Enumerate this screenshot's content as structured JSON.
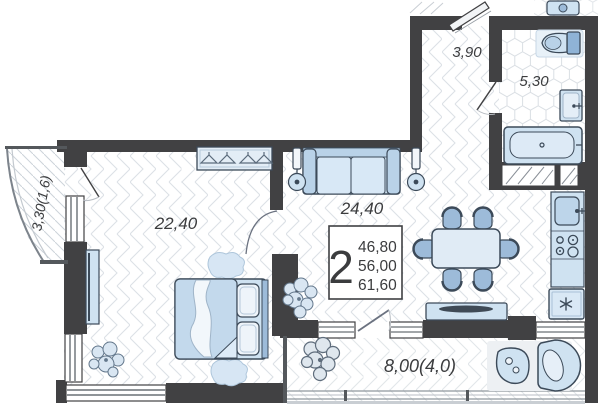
{
  "rooms": {
    "bedroom": {
      "label": "22,40"
    },
    "living": {
      "label": "24,40"
    },
    "hallway": {
      "label": "3,90"
    },
    "bathroom": {
      "label": "5,30"
    },
    "balcony_left": {
      "label": "3,30(1,6)"
    },
    "balcony_bottom": {
      "label": "8,00(4,0)"
    }
  },
  "info_box": {
    "rooms_count": "2",
    "living_area": "46,80",
    "area": "56,00",
    "total_area": "61,60"
  },
  "kitchen": {
    "fridge_symbol": "✳"
  },
  "colors": {
    "wall": "#414143",
    "furniture_stroke": "#3c4a59",
    "furniture_fill": "#cfe2f1",
    "furniture_fill_dark": "#9dbbd9",
    "floor_pattern_line": "#dce1e6",
    "label_text": "#3b3c3e"
  }
}
